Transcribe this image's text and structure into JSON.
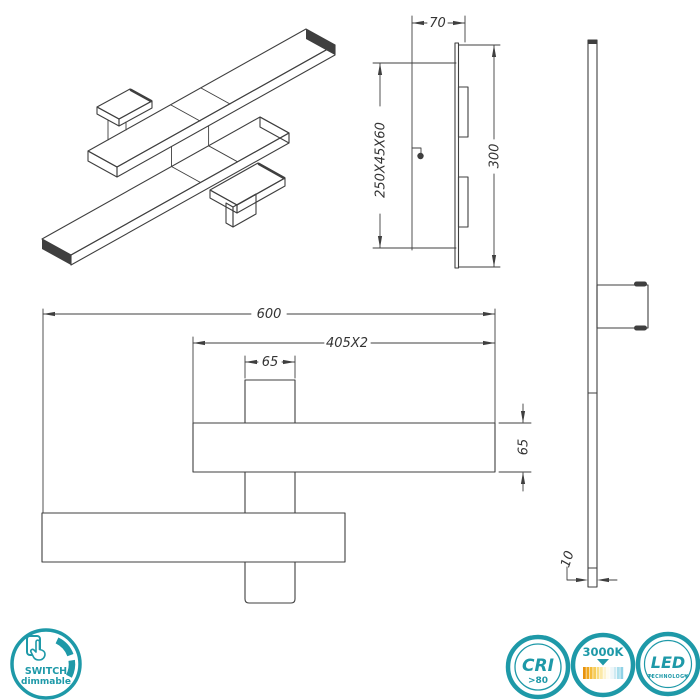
{
  "views": {
    "side": {
      "depth": "70",
      "mount_box": "250X45X60",
      "height": "300"
    },
    "front": {
      "total_width": "600",
      "bar_length": "405X2",
      "block_width": "65",
      "bar_height": "65"
    },
    "profile": {
      "thickness": "10"
    }
  },
  "badges": {
    "switch": {
      "line1": "SWITCH",
      "line2": "dimmable"
    },
    "cri": {
      "label": "CRI",
      "value": ">80"
    },
    "color_temperature": {
      "label": "3000K"
    },
    "led": {
      "label": "LED",
      "sub": "TECHNOLOGY"
    }
  },
  "colors": {
    "accent_teal": "#1e99a8",
    "line": "#3f3f3f",
    "warm_end": "#e8920c",
    "cool_end": "#8fd2e6"
  }
}
